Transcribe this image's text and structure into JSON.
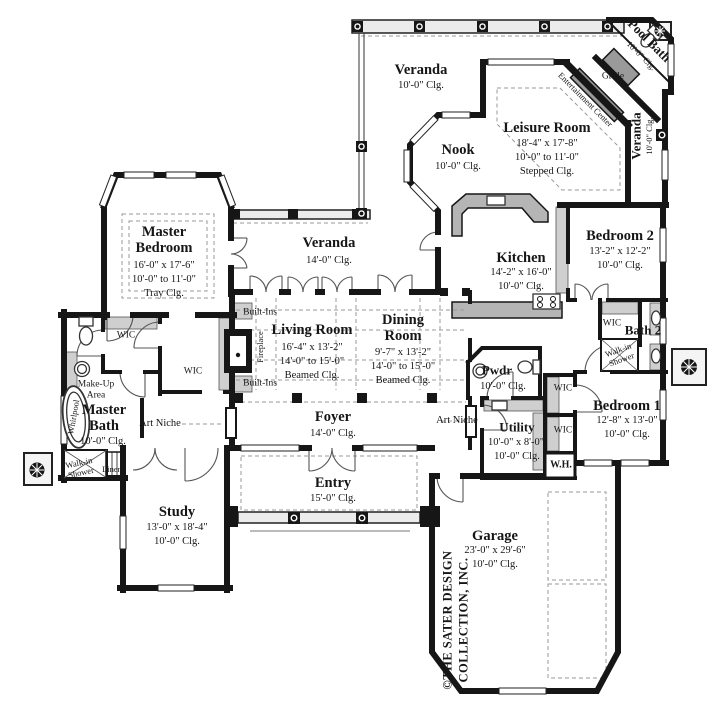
{
  "rooms": {
    "master_bedroom": {
      "name": "Master Bedroom",
      "dims": "16'-0\" x 17'-6\"",
      "range": "10'-0\" to 11'-0\"",
      "ceiling": "Tray Clg."
    },
    "veranda_top": {
      "name": "Veranda",
      "ceiling": "10'-0\" Clg."
    },
    "veranda_mid": {
      "name": "Veranda",
      "ceiling": "14'-0\" Clg."
    },
    "veranda_right": {
      "name": "Veranda",
      "ceiling": "10'-0\" Clg."
    },
    "nook": {
      "name": "Nook",
      "ceiling": "10'-0\" Clg."
    },
    "leisure": {
      "name": "Leisure Room",
      "dims": "18'-4\" x 17'-8\"",
      "range": "10'-0\" to 11'-0\"",
      "ceiling": "Stepped Clg."
    },
    "pool_bath": {
      "name": "Pool Bath",
      "ceiling": "10'-0\" Clg."
    },
    "kitchen": {
      "name": "Kitchen",
      "dims": "14'-2\" x 16'-0\"",
      "ceiling": "10'-0\" Clg."
    },
    "bedroom2": {
      "name": "Bedroom 2",
      "dims": "13'-2\" x 12'-2\"",
      "ceiling": "10'-0\" Clg."
    },
    "bath2": {
      "name": "Bath 2"
    },
    "bedroom1": {
      "name": "Bedroom 1",
      "dims": "12'-8\" x 13'-0\"",
      "ceiling": "10'-0\" Clg."
    },
    "living": {
      "name": "Living Room",
      "dims": "16'-4\" x 13'-2\"",
      "range": "14'-0\" to 15'-0\"",
      "ceiling": "Beamed Clg."
    },
    "dining": {
      "name": "Dining Room",
      "dims": "9'-7\" x 13'-2\"",
      "range": "14'-0\" to 15'-0\"",
      "ceiling": "Beamed Clg."
    },
    "foyer": {
      "name": "Foyer",
      "ceiling": "14'-0\" Clg."
    },
    "entry": {
      "name": "Entry",
      "ceiling": "15'-0\" Clg."
    },
    "study": {
      "name": "Study",
      "dims": "13'-0\" x 18'-4\"",
      "ceiling": "10'-0\" Clg."
    },
    "garage": {
      "name": "Garage",
      "dims": "23'-0\" x 29'-6\"",
      "ceiling": "10'-0\" Clg."
    },
    "master_bath": {
      "name": "Master Bath",
      "ceiling": "10'-0\" Clg."
    },
    "pwdr": {
      "name": "Pwdr",
      "ceiling": "10'-0\" Clg."
    },
    "utility": {
      "name": "Utility",
      "dims": "10'-0\" x 8'-0\"",
      "ceiling": "10'-0\" Clg."
    }
  },
  "features": {
    "entertainment_center": "Entertainment Center",
    "grille": "Grille",
    "built_ins": "Built-Ins",
    "fireplace": "Fireplace",
    "art_niche": "Art Niche",
    "wic": "WIC",
    "walk_in_shower": "Walk-in Shower",
    "linen": "Linen",
    "whirlpool": "Whirlpool",
    "make_up": "Make-Up Area",
    "water_heater": "W.H."
  },
  "branding": {
    "copyright_line1": "©THE SATER DESIGN",
    "copyright_line2": "COLLECTION, INC."
  },
  "colors": {
    "wall": "#161616",
    "counter": "#b5b5b5",
    "shelf": "#cfcfcf",
    "dash": "#999999"
  }
}
